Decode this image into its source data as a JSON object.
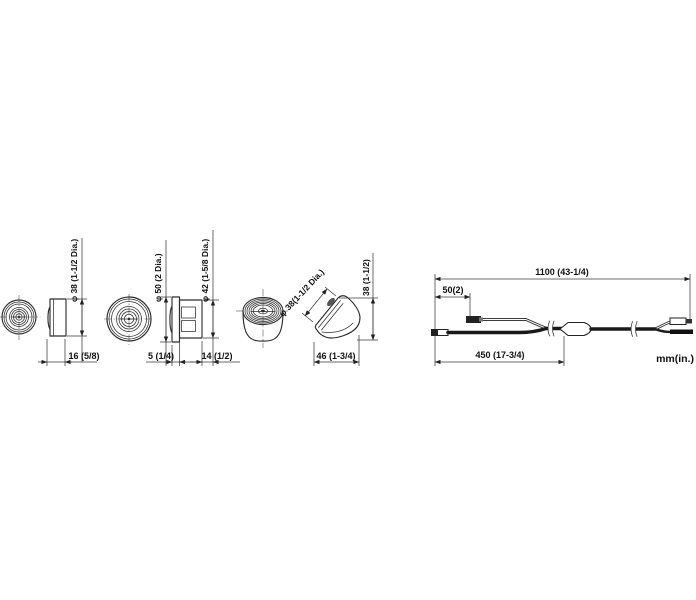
{
  "meta": {
    "units_label": "mm(in.)",
    "colors": {
      "line": "#2e2e2e",
      "text": "#111111",
      "background": "#ffffff"
    }
  },
  "views": {
    "camera_flush": {
      "dia": "φ 38 (1-1/2 Dia.)",
      "depth": "16 (5/8)"
    },
    "camera_flange": {
      "dia_outer": "φ 50 (2 Dia.)",
      "dia_body": "φ 42 (1-5/8 Dia.)",
      "flange_thickness": "5 (1/4)",
      "body_depth": "14 (1/2)"
    },
    "camera_angled": {
      "dia_lens": "φ 38(1-1/2 Dia.)",
      "height": "38 (1-1/2)",
      "width": "46 (1-3/4)"
    },
    "cable": {
      "total": "1100 (43-1/4)",
      "branch": "50(2)",
      "lead": "450 (17-3/4)"
    }
  }
}
